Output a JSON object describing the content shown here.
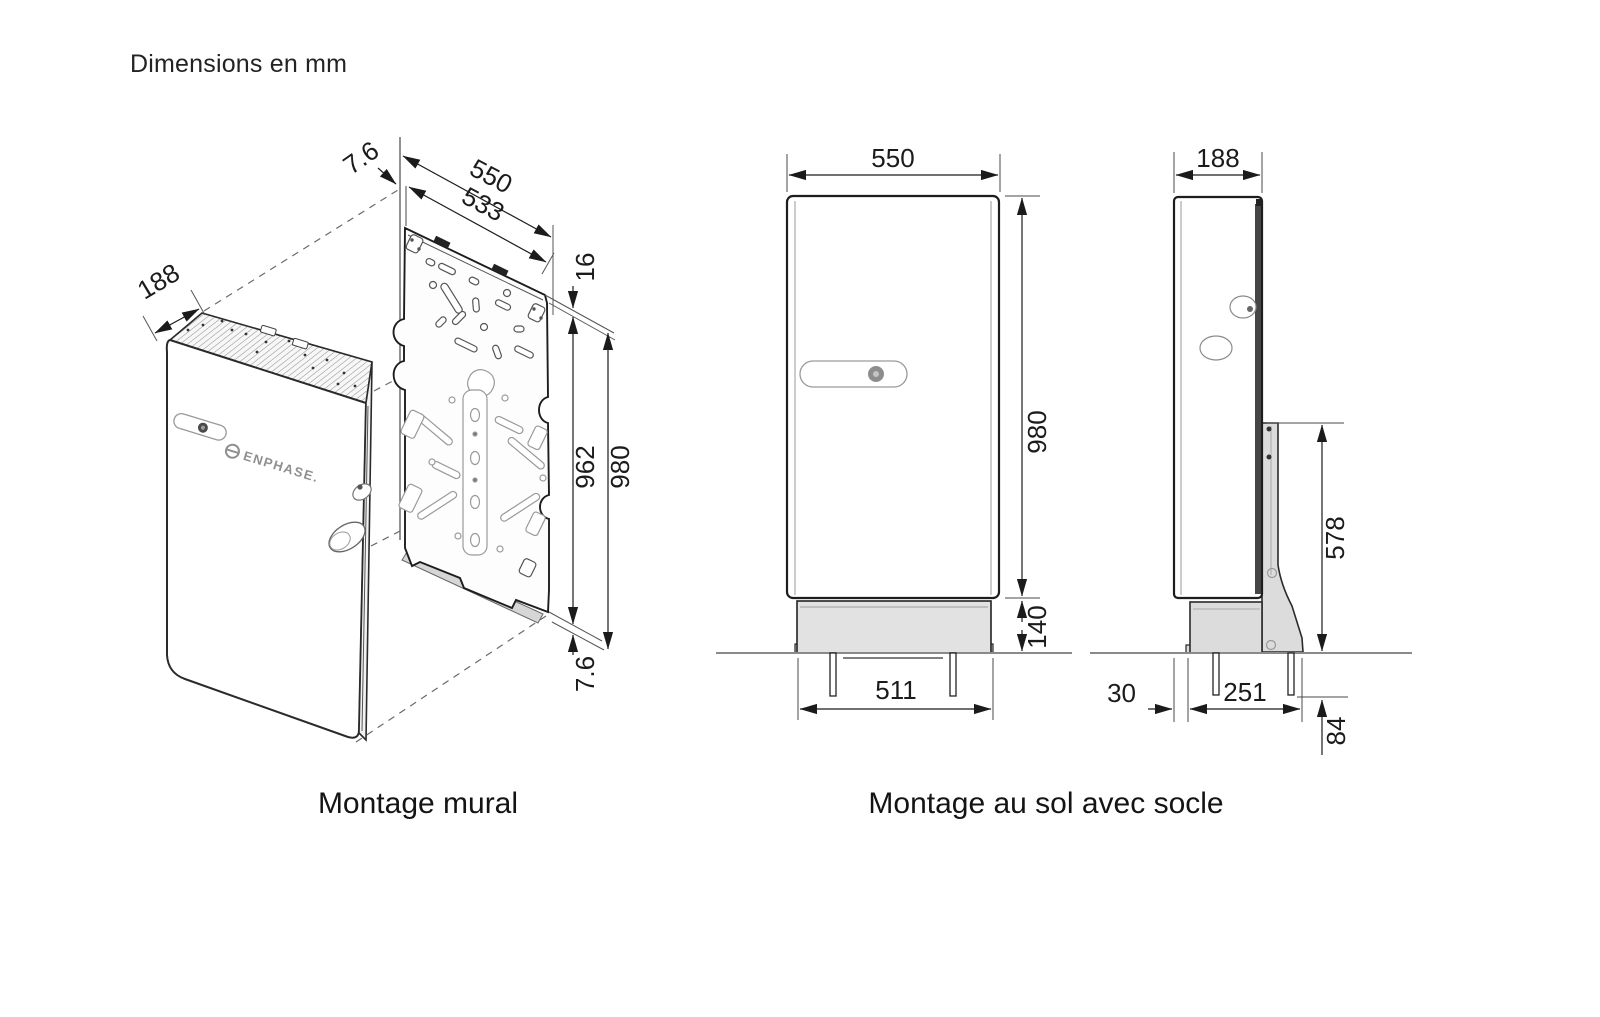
{
  "page": {
    "title": "Dimensions en mm"
  },
  "palette": {
    "line": "#1d1d1d",
    "thin_line": "#555555",
    "shade_gray": "#e2e2e2",
    "bracket_gray": "#dcdcdc",
    "ground_gray": "#8a8a8a"
  },
  "wall_mount": {
    "caption": "Montage mural",
    "brand": "ENPHASE.",
    "dims": {
      "plate_standoff_top": "7.6",
      "overall_width": "550",
      "plate_width": "533",
      "top_clearance": "16",
      "depth": "188",
      "plate_height": "962",
      "overall_height": "980",
      "plate_standoff_bottom": "7.6"
    }
  },
  "floor_mount": {
    "caption": "Montage au sol avec socle",
    "front_view": {
      "overall_width": "550",
      "overall_height": "980",
      "base_height": "140",
      "anchor_span": "511"
    },
    "side_view": {
      "depth": "188",
      "bracket_height": "578",
      "front_setback": "30",
      "base_depth": "251",
      "anchor_depth": "84"
    }
  }
}
